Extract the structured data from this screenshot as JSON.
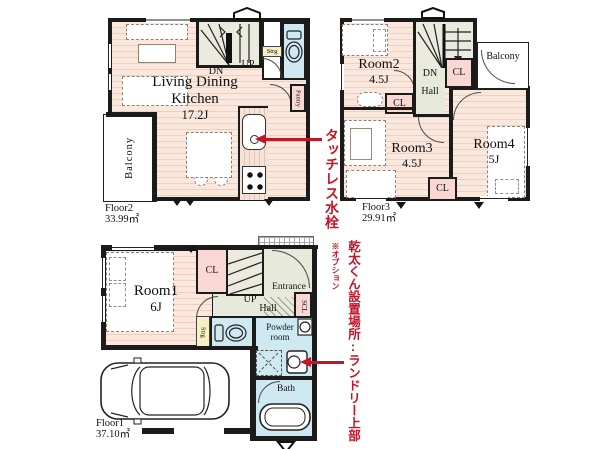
{
  "colors": {
    "wall": "#1b1b1b",
    "room_floor": "#fbe7dc",
    "stairs": "#eaeadf",
    "water_rooms": "#cfe9f2",
    "closets": "#f9d8d4",
    "accent_red": "#c41428"
  },
  "floor2": {
    "name": "Floor2",
    "area": "33.99㎡",
    "ldk1": "Living Dining",
    "ldk2": "Kitchen",
    "ldk_size": "17.2J",
    "balcony": "Balcony",
    "dn": "DN",
    "up": "UP",
    "strg": "Strg",
    "pantry": "Pantry"
  },
  "floor3": {
    "name": "Floor3",
    "area": "29.91㎡",
    "room2": "Room2",
    "room2_size": "4.5J",
    "room3": "Room3",
    "room3_size": "4.5J",
    "room4": "Room4",
    "room4_size": "5J",
    "balcony": "Balcony",
    "dn": "DN",
    "hall": "Hall",
    "cl": "CL"
  },
  "floor1": {
    "name": "Floor1",
    "area": "37.10㎡",
    "room1": "Room1",
    "room1_size": "6J",
    "cl": "CL",
    "up": "UP",
    "hall": "Hall",
    "entrance": "Entrance",
    "scl": "SCL",
    "strg": "Strg",
    "powder1": "Powder",
    "powder2": "room",
    "bath": "Bath"
  },
  "annotations": {
    "touchless": "タッチレス水栓",
    "kanta": "乾太くん設置場所:ランドリー上部",
    "kanta_note": "※オプション"
  }
}
